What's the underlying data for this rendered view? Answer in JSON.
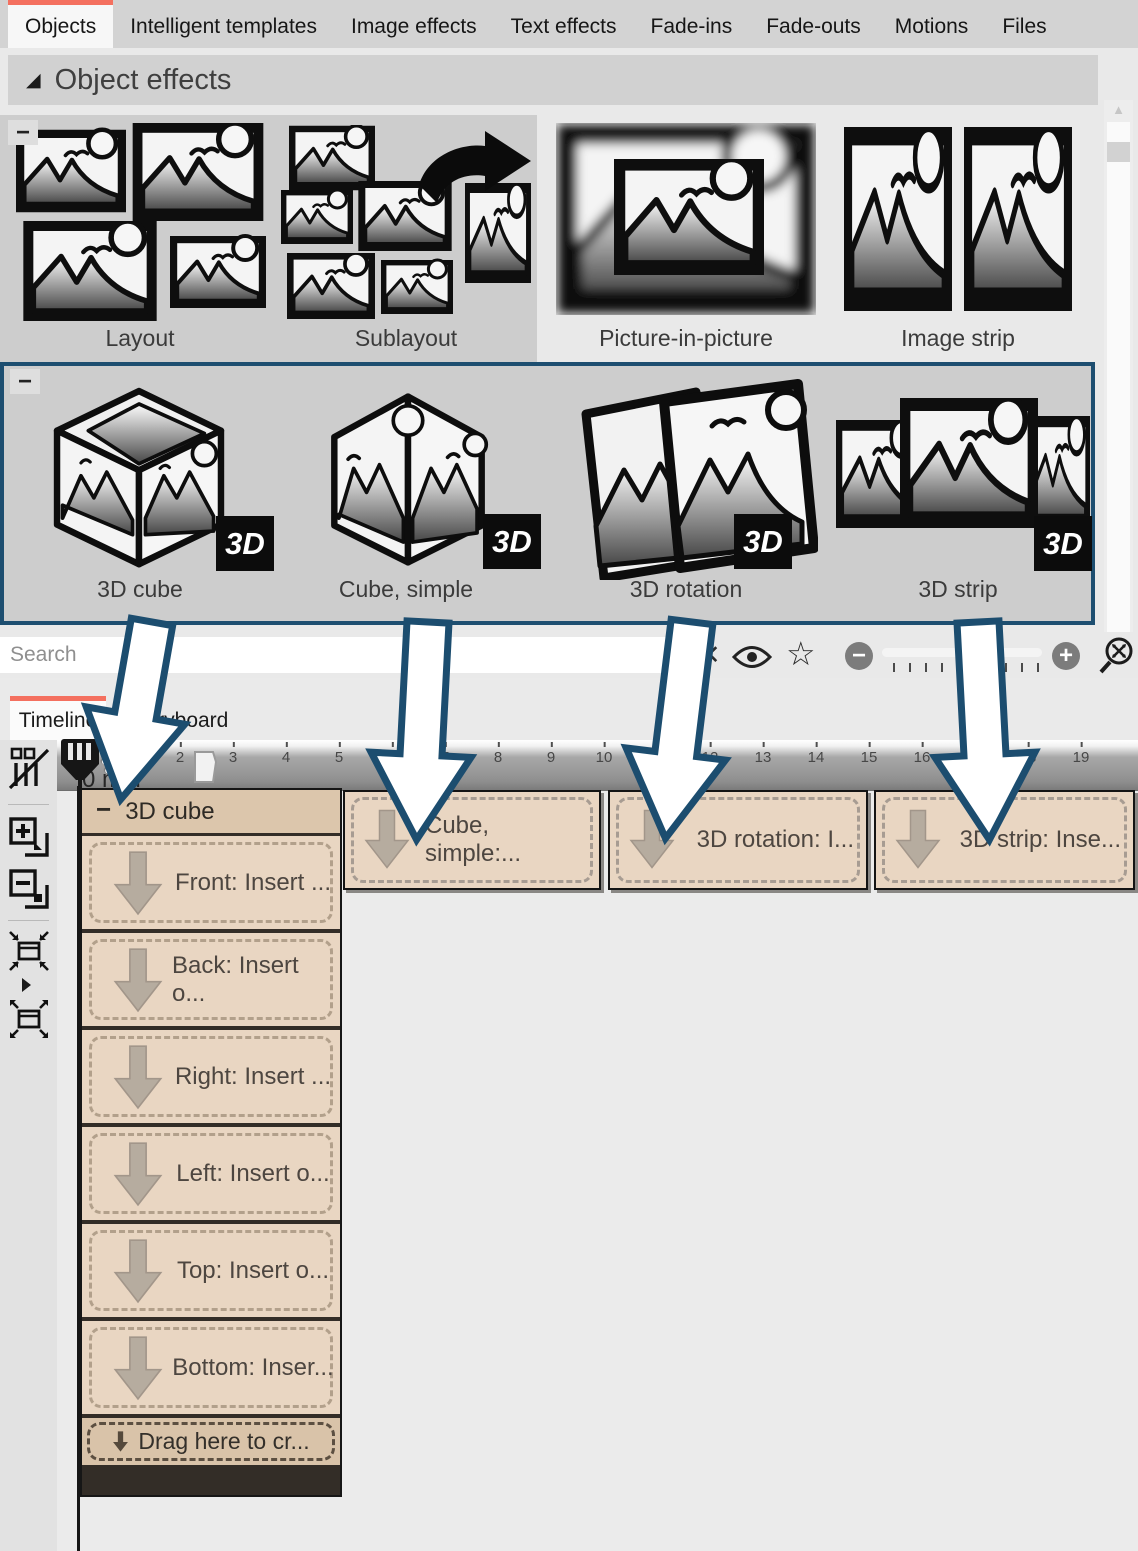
{
  "colors": {
    "accent_red": "#f4705f",
    "selection_navy": "#1d4e70",
    "clip_tan": "#e9d6c2",
    "panel_gray": "#cdcdcd"
  },
  "tab_bar": {
    "tabs": [
      {
        "label": "Objects",
        "active": true
      },
      {
        "label": "Intelligent templates"
      },
      {
        "label": "Image effects"
      },
      {
        "label": "Text effects"
      },
      {
        "label": "Fade-ins"
      },
      {
        "label": "Fade-outs"
      },
      {
        "label": "Motions"
      },
      {
        "label": "Files"
      }
    ]
  },
  "palette": {
    "section": {
      "collapse_glyph": "◢",
      "title": "Object effects",
      "collapse_badge": "−"
    },
    "row1": [
      {
        "label": "Layout"
      },
      {
        "label": "Sublayout"
      },
      {
        "label": "Picture-in-picture"
      },
      {
        "label": "Image strip"
      }
    ],
    "row2": [
      {
        "label": "3D cube",
        "badge": "3D"
      },
      {
        "label": "Cube, simple",
        "badge": "3D"
      },
      {
        "label": "3D rotation",
        "badge": "3D"
      },
      {
        "label": "3D strip",
        "badge": "3D"
      }
    ],
    "scrollbar": {
      "up_glyph": "▲",
      "down_glyph": "▼"
    }
  },
  "toolbar": {
    "search_placeholder": "Search",
    "icons": {
      "clear": "✕",
      "eye": "eye-icon",
      "star": "☆",
      "zoom_out": "−",
      "zoom_in": "+",
      "zoom_reset": "magnifier-reset-icon"
    }
  },
  "timeline": {
    "tabs": [
      {
        "label": "Timeline",
        "active": true
      },
      {
        "label": "Storyboard"
      }
    ],
    "time_label": "0 min",
    "ruler_numbers": [
      1,
      2,
      3,
      4,
      5,
      6,
      7,
      8,
      9,
      10,
      11,
      12,
      13,
      14,
      15,
      16,
      17,
      18,
      19
    ],
    "group": {
      "collapse_glyph": "−",
      "title": "3D cube",
      "tracks": [
        "Front: Insert ...",
        "Back: Insert o...",
        "Right: Insert ...",
        "Left: Insert o...",
        "Top: Insert o...",
        "Bottom: Inser..."
      ],
      "drop_label": "Drag here to cr..."
    },
    "clips": [
      {
        "label": "Cube, simple:..."
      },
      {
        "label": "3D rotation: I..."
      },
      {
        "label": "3D strip: Inse..."
      }
    ]
  }
}
